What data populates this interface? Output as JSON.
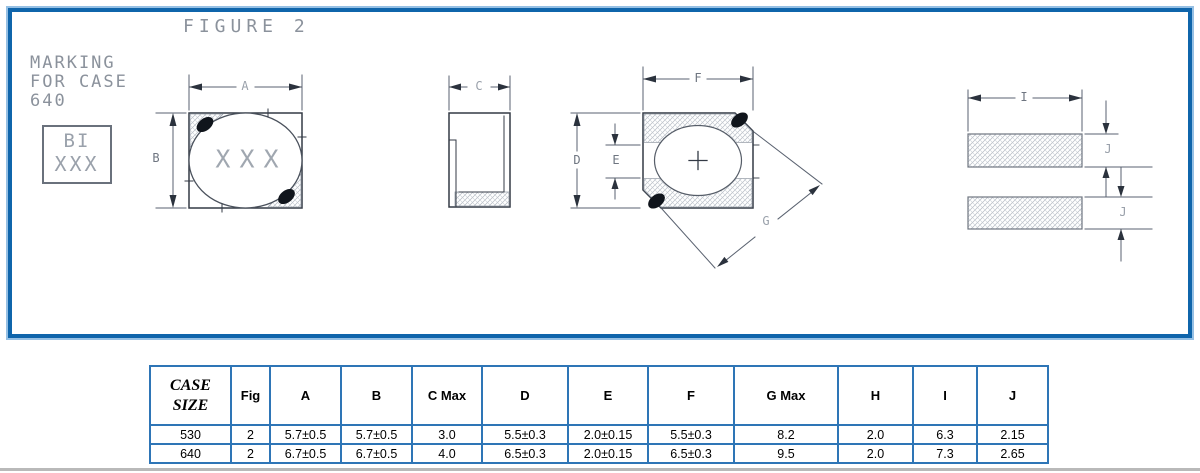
{
  "figure": {
    "title": "FIGURE 2",
    "marking_note": [
      "MARKING",
      "FOR CASE",
      "640"
    ],
    "marking_box": [
      "BI",
      "XXX"
    ],
    "body_marking": "XXX",
    "dim_labels": {
      "a": "A",
      "b": "B",
      "c": "C",
      "d": "D",
      "e": "E",
      "f": "F",
      "g": "G",
      "i": "I",
      "j": "J"
    }
  },
  "table": {
    "headers": [
      "CASE SIZE",
      "Fig",
      "A",
      "B",
      "C Max",
      "D",
      "E",
      "F",
      "G Max",
      "H",
      "I",
      "J"
    ],
    "rows": [
      [
        "530",
        "2",
        "5.7±0.5",
        "5.7±0.5",
        "3.0",
        "5.5±0.3",
        "2.0±0.15",
        "5.5±0.3",
        "8.2",
        "2.0",
        "6.3",
        "2.15"
      ],
      [
        "640",
        "2",
        "6.7±0.5",
        "6.7±0.5",
        "4.0",
        "6.5±0.3",
        "2.0±0.15",
        "6.5±0.3",
        "9.5",
        "2.0",
        "7.3",
        "2.65"
      ]
    ]
  },
  "colors": {
    "frame_border": "#0f65ab",
    "frame_outer": "#96c0e4",
    "table_border": "#2e75b6",
    "object_line": "#333a45",
    "dim_line": "#5a6270",
    "cad_text": "#9aa1ab",
    "hatch": "#b3b9c2",
    "black_mark": "#10151c",
    "divider": "#b9b9b9"
  }
}
